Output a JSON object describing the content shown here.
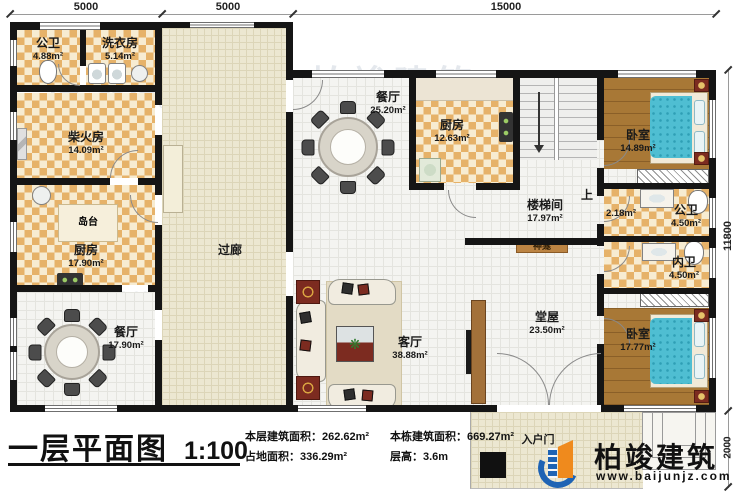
{
  "title_block": {
    "title": "一层平面图",
    "scale": "1:100",
    "stats": [
      {
        "text": "本层建筑面积：262.62m²"
      },
      {
        "text": "本栋建筑面积：669.27m²"
      },
      {
        "text": "占地面积：336.29m²"
      },
      {
        "text": "层高：3.6m"
      }
    ],
    "brand": {
      "name": "柏竣建筑",
      "website": "www.baijunjz.com"
    }
  },
  "dimensions": {
    "top": [
      "5000",
      "5000",
      "15000"
    ],
    "right": "11800",
    "bottom_right": "2000"
  },
  "rooms": {
    "gongwei_left": {
      "name": "公卫",
      "area": "4.88m²"
    },
    "xiyifang": {
      "name": "洗衣房",
      "area": "5.14m²"
    },
    "chaihuofang": {
      "name": "柴火房",
      "area": "14.09m²"
    },
    "daotai": {
      "name": "岛台"
    },
    "chufang_left": {
      "name": "厨房",
      "area": "17.90m²"
    },
    "canting_left": {
      "name": "餐厅",
      "area": "17.90m²"
    },
    "guolang": {
      "name": "过廊"
    },
    "canting_mid": {
      "name": "餐厅",
      "area": "25.20m²"
    },
    "chufang_mid": {
      "name": "厨房",
      "area": "12.63m²"
    },
    "loutijian": {
      "name": "楼梯间",
      "area": "17.97m²"
    },
    "shang": {
      "name": "上",
      "area": "2.18m²"
    },
    "woshi_top": {
      "name": "卧室",
      "area": "14.89m²"
    },
    "gongwei_right": {
      "name": "公卫",
      "area": "4.50m²"
    },
    "neiwei": {
      "name": "内卫",
      "area": "4.50m²"
    },
    "woshi_bottom": {
      "name": "卧室",
      "area": "17.77m²"
    },
    "tangwu": {
      "name": "堂屋",
      "area": "23.50m²"
    },
    "shenkan": {
      "name": "神龛"
    },
    "keting": {
      "name": "客厅",
      "area": "38.88m²"
    },
    "ruhumen": {
      "name": "入户门"
    }
  },
  "icons": {
    "plant": "❋"
  },
  "watermark": {
    "line1": "柏竣建筑",
    "line2": "www.baijunjz.com"
  },
  "colors": {
    "wall": "#151515",
    "checker": "#e6b269",
    "wood": "#a87836",
    "bed": "#4fbed2",
    "accent_red": "#7c2b20",
    "brand_blue": "#1e63b4",
    "brand_orange": "#ef8a1d"
  }
}
